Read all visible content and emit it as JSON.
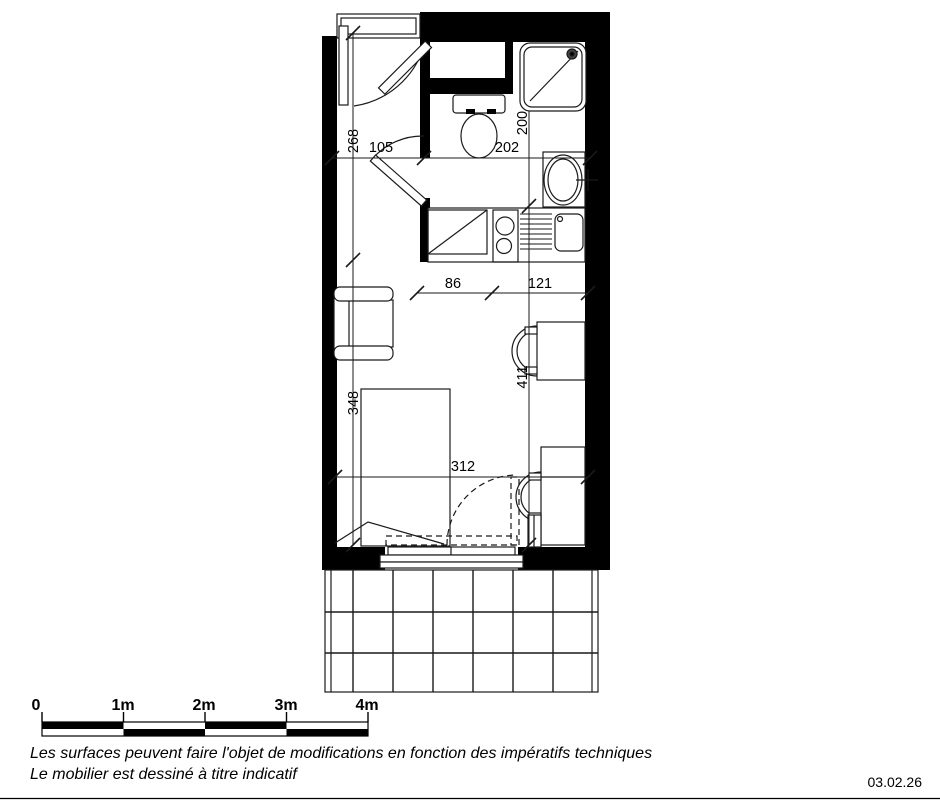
{
  "dimensions": {
    "entry_depth": "268",
    "entry_width": "105",
    "wc_width": "202",
    "wc_depth": "200",
    "kitchen_width": "86",
    "kitchen_to_wall": "121",
    "living_depth": "348",
    "living_right_depth": "411",
    "living_width": "312"
  },
  "scale_bar": {
    "labels": [
      "0",
      "1m",
      "2m",
      "3m",
      "4m"
    ]
  },
  "notes": {
    "line1": "Les surfaces peuvent faire l'objet de modifications en fonction des impératifs techniques",
    "line2": "Le mobilier est dessiné à titre indicatif"
  },
  "date": "03.02.26",
  "colors": {
    "ink": "#000000",
    "paper": "#ffffff"
  }
}
